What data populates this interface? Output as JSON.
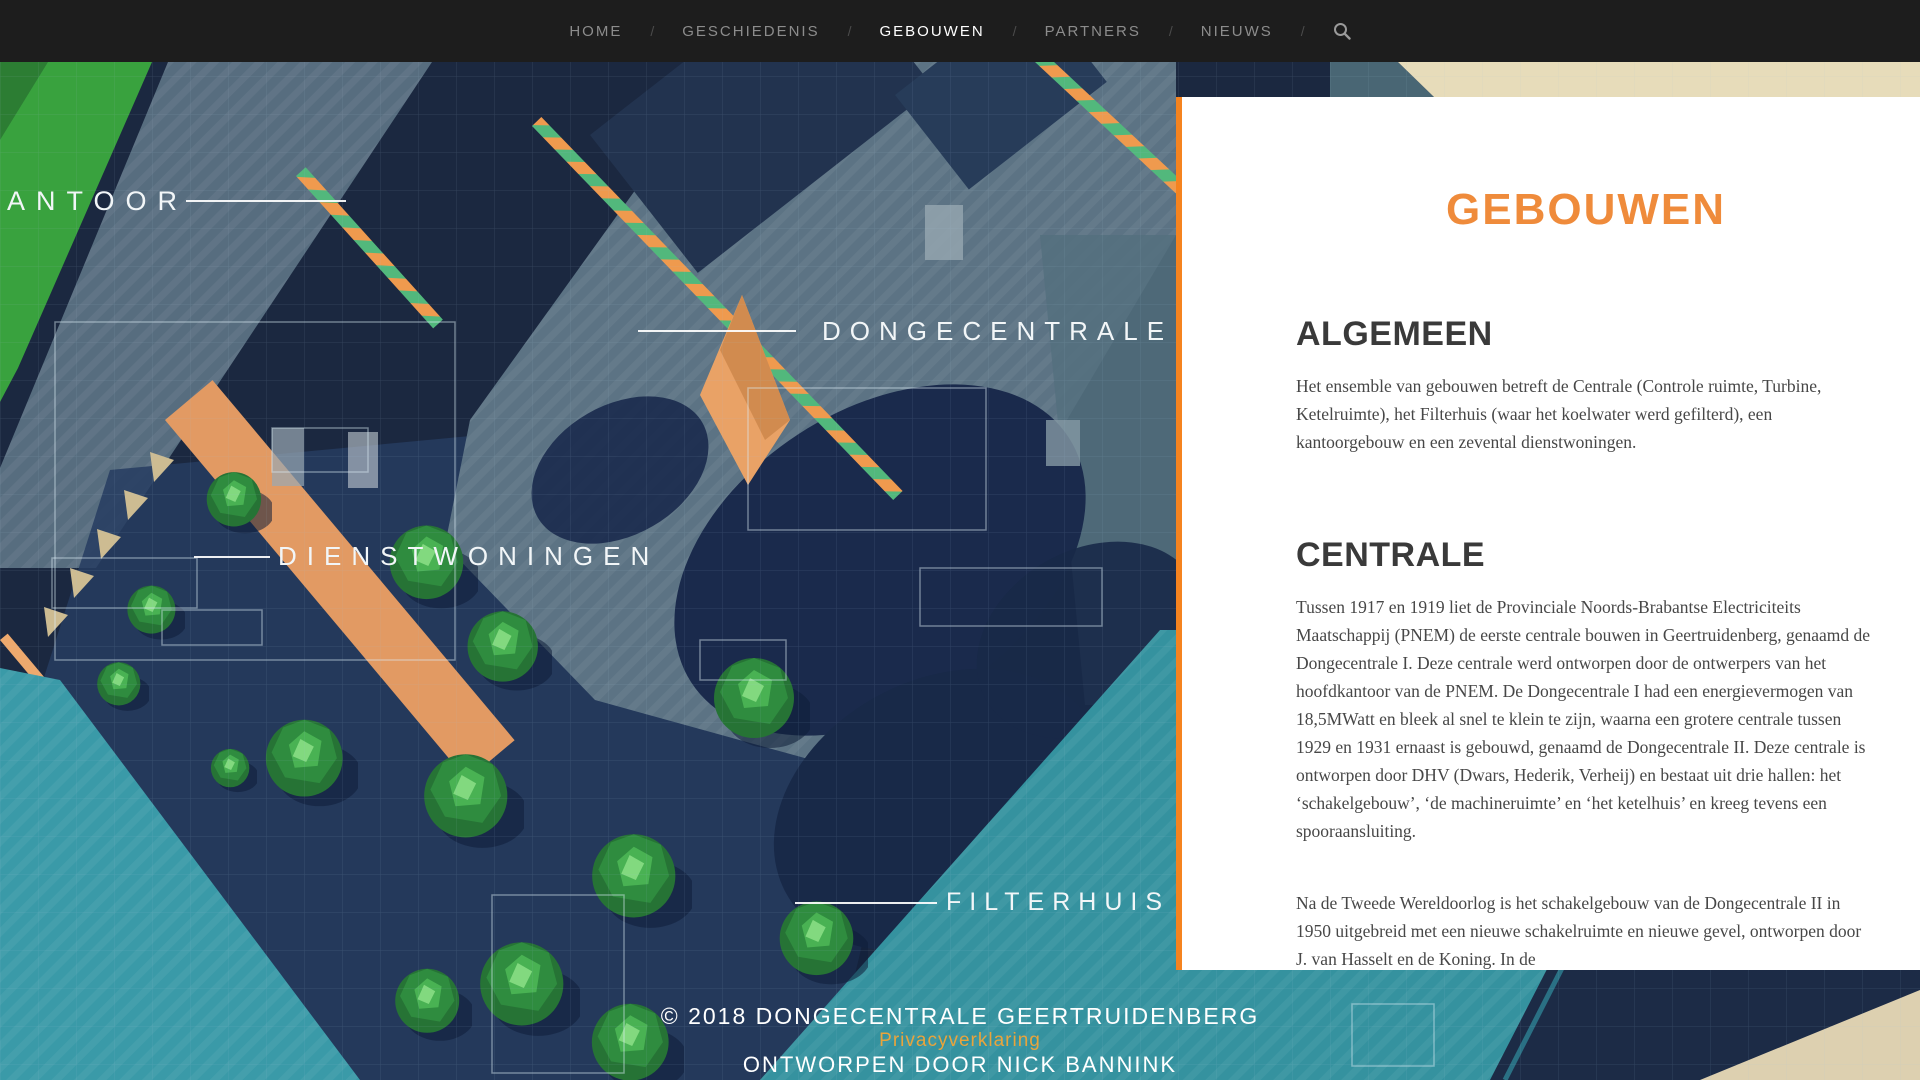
{
  "nav": {
    "separator": "/",
    "items": [
      {
        "label": "HOME",
        "active": false
      },
      {
        "label": "GESCHIEDENIS",
        "active": false
      },
      {
        "label": "GEBOUWEN",
        "active": true
      },
      {
        "label": "PARTNERS",
        "active": false
      },
      {
        "label": "NIEUWS",
        "active": false
      }
    ],
    "search_icon": "magnifier"
  },
  "map": {
    "labels": {
      "kantoor": "KANTOOR",
      "dongecentrale": "DONGECENTRALE",
      "dienstwoningen": "DIENSTWONINGEN",
      "filterhuis": "FILTERHUIS"
    }
  },
  "panel": {
    "title": "GEBOUWEN",
    "sections": [
      {
        "heading": "ALGEMEEN",
        "paragraphs": [
          "Het ensemble van gebouwen betreft de Centrale (Controle ruimte, Turbine, Ketelruimte), het Filterhuis (waar het koelwater werd gefilterd), een kantoorgebouw en een zevental dienstwoningen."
        ]
      },
      {
        "heading": "CENTRALE",
        "paragraphs": [
          "Tussen 1917 en 1919 liet de Provinciale Noords-Brabantse Electriciteits Maatschappij (PNEM) de eerste centrale bouwen in Geertruidenberg, genaamd de Dongecentrale I. Deze centrale werd ontworpen door de ontwerpers van het hoofdkantoor van de PNEM. De Dongecentrale I had een energievermogen van 18,5MWatt en bleek al snel te klein te zijn, waarna een grotere centrale tussen 1929 en 1931 ernaast is gebouwd, genaamd de Dongecentrale II. Deze centrale is ontworpen door DHV (Dwars, Hederik, Verheij) en bestaat uit drie hallen: het ‘schakelgebouw’, ‘de machineruimte’ en ‘het ketelhuis’ en kreeg tevens een spooraansluiting.",
          "Na de Tweede Wereldoorlog is het schakelgebouw van de Dongecentrale II in 1950 uitgebreid met een nieuwe schakelruimte en nieuwe gevel, ontworpen door J. van Hasselt en de Koning. In de"
        ]
      }
    ]
  },
  "footer": {
    "copyright": "© 2018 DONGECENTRALE GEERTRUIDENBERG",
    "privacy_link": "Privacyverklaring",
    "credit": "ONTWORPEN DOOR NICK BANNINK"
  },
  "colors": {
    "accent_orange": "#f08a36",
    "panel_border_orange": "#f5831f",
    "privacy_link_orange": "#e9a43c",
    "nav_background": "#1d1d1d",
    "nav_inactive": "#8c8c8c",
    "nav_active": "#ffffff",
    "map_navy": "#1b2840",
    "map_water_teal": "#35929f",
    "map_green": "#39a23e",
    "map_grey_blue": "#5c7384",
    "map_tan": "#ded1b0"
  }
}
